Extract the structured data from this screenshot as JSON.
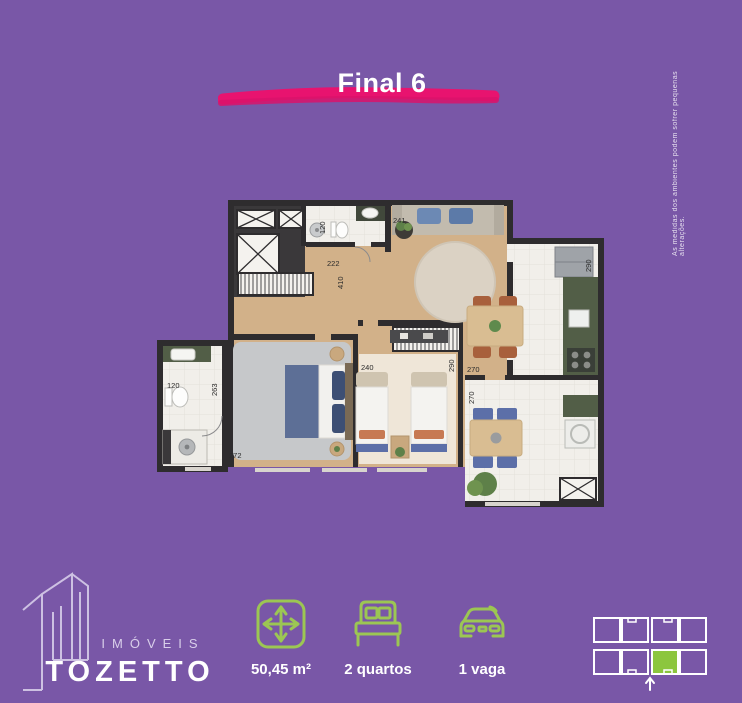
{
  "header": {
    "title": "Final 6"
  },
  "disclaimer": "As medidas dos ambientes podem sofrer pequenas alterações.",
  "floor_plan": {
    "measurements": [
      "120",
      "222",
      "241",
      "410",
      "290",
      "120",
      "263",
      "272",
      "240",
      "290",
      "270",
      "270"
    ]
  },
  "specs": [
    {
      "icon": "area-icon",
      "label": "50,45 m²"
    },
    {
      "icon": "bed-icon",
      "label": "2 quartos"
    },
    {
      "icon": "car-icon",
      "label": "1 vaga"
    }
  ],
  "logo": {
    "subtitle": "IMÓVEIS",
    "name": "TOZETTO"
  },
  "colors": {
    "background": "#7957A7",
    "title_underline": "#E8136F",
    "icon_green": "#9CC653",
    "locator_highlight": "#8CC63E",
    "plan_wall": "#2E2C2E"
  }
}
